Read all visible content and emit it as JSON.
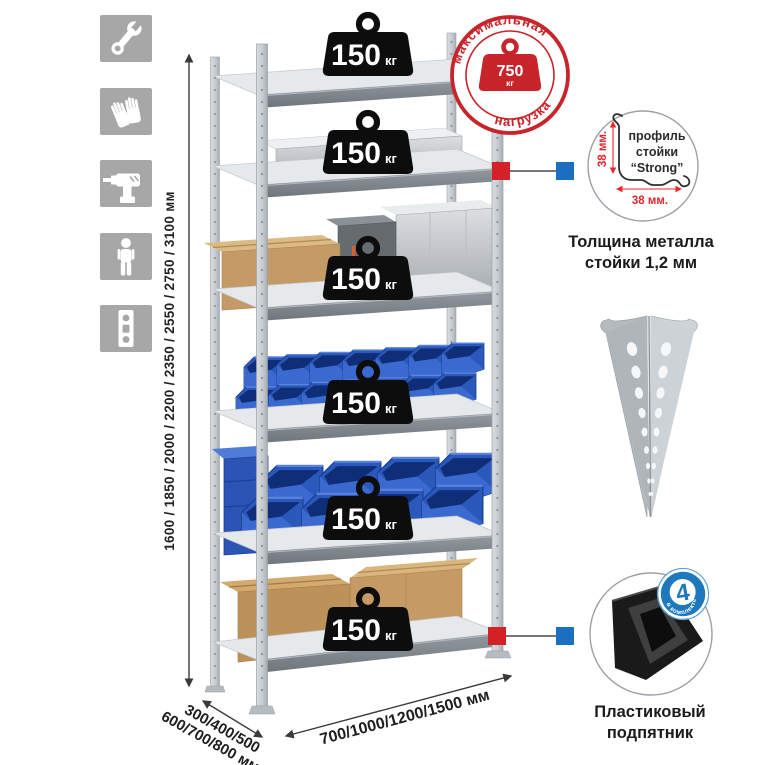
{
  "colors": {
    "accent_red": "#d42127",
    "accent_blue": "#1a6fc0",
    "stamp_red": "#c8242b",
    "bin_blue": "#2a58bb",
    "icon_gray": "#a7a7a7"
  },
  "sidebar": {
    "icons": [
      {
        "name": "wrench-icon"
      },
      {
        "name": "gloves-icon"
      },
      {
        "name": "drill-icon"
      },
      {
        "name": "person-icon"
      },
      {
        "name": "perforated-strip-icon"
      }
    ]
  },
  "dimensions": {
    "height": "1600 / 1850 / 2000 / 2200 / 2350 / 2550 / 2750 / 3100 мм",
    "depth_line1": "300/400/500",
    "depth_line2": "600/700/800 мм",
    "width": "700/1000/1200/1500 мм"
  },
  "load_badge": {
    "value": "150",
    "unit": "кг"
  },
  "stamp": {
    "top": "максимальная",
    "bottom": "нагрузка",
    "value": "750",
    "unit": "кг"
  },
  "profile_detail": {
    "line1": "профиль",
    "line2": "стойки",
    "line3": "“Strong”",
    "dim_v": "38 мм.",
    "dim_h": "38 мм.",
    "caption1": "Толщина металла",
    "caption2": "стойки 1,2 мм"
  },
  "foot_detail": {
    "count": "4",
    "badge_arc": "в комплекте",
    "caption1": "Пластиковый",
    "caption2": "подпятник"
  }
}
